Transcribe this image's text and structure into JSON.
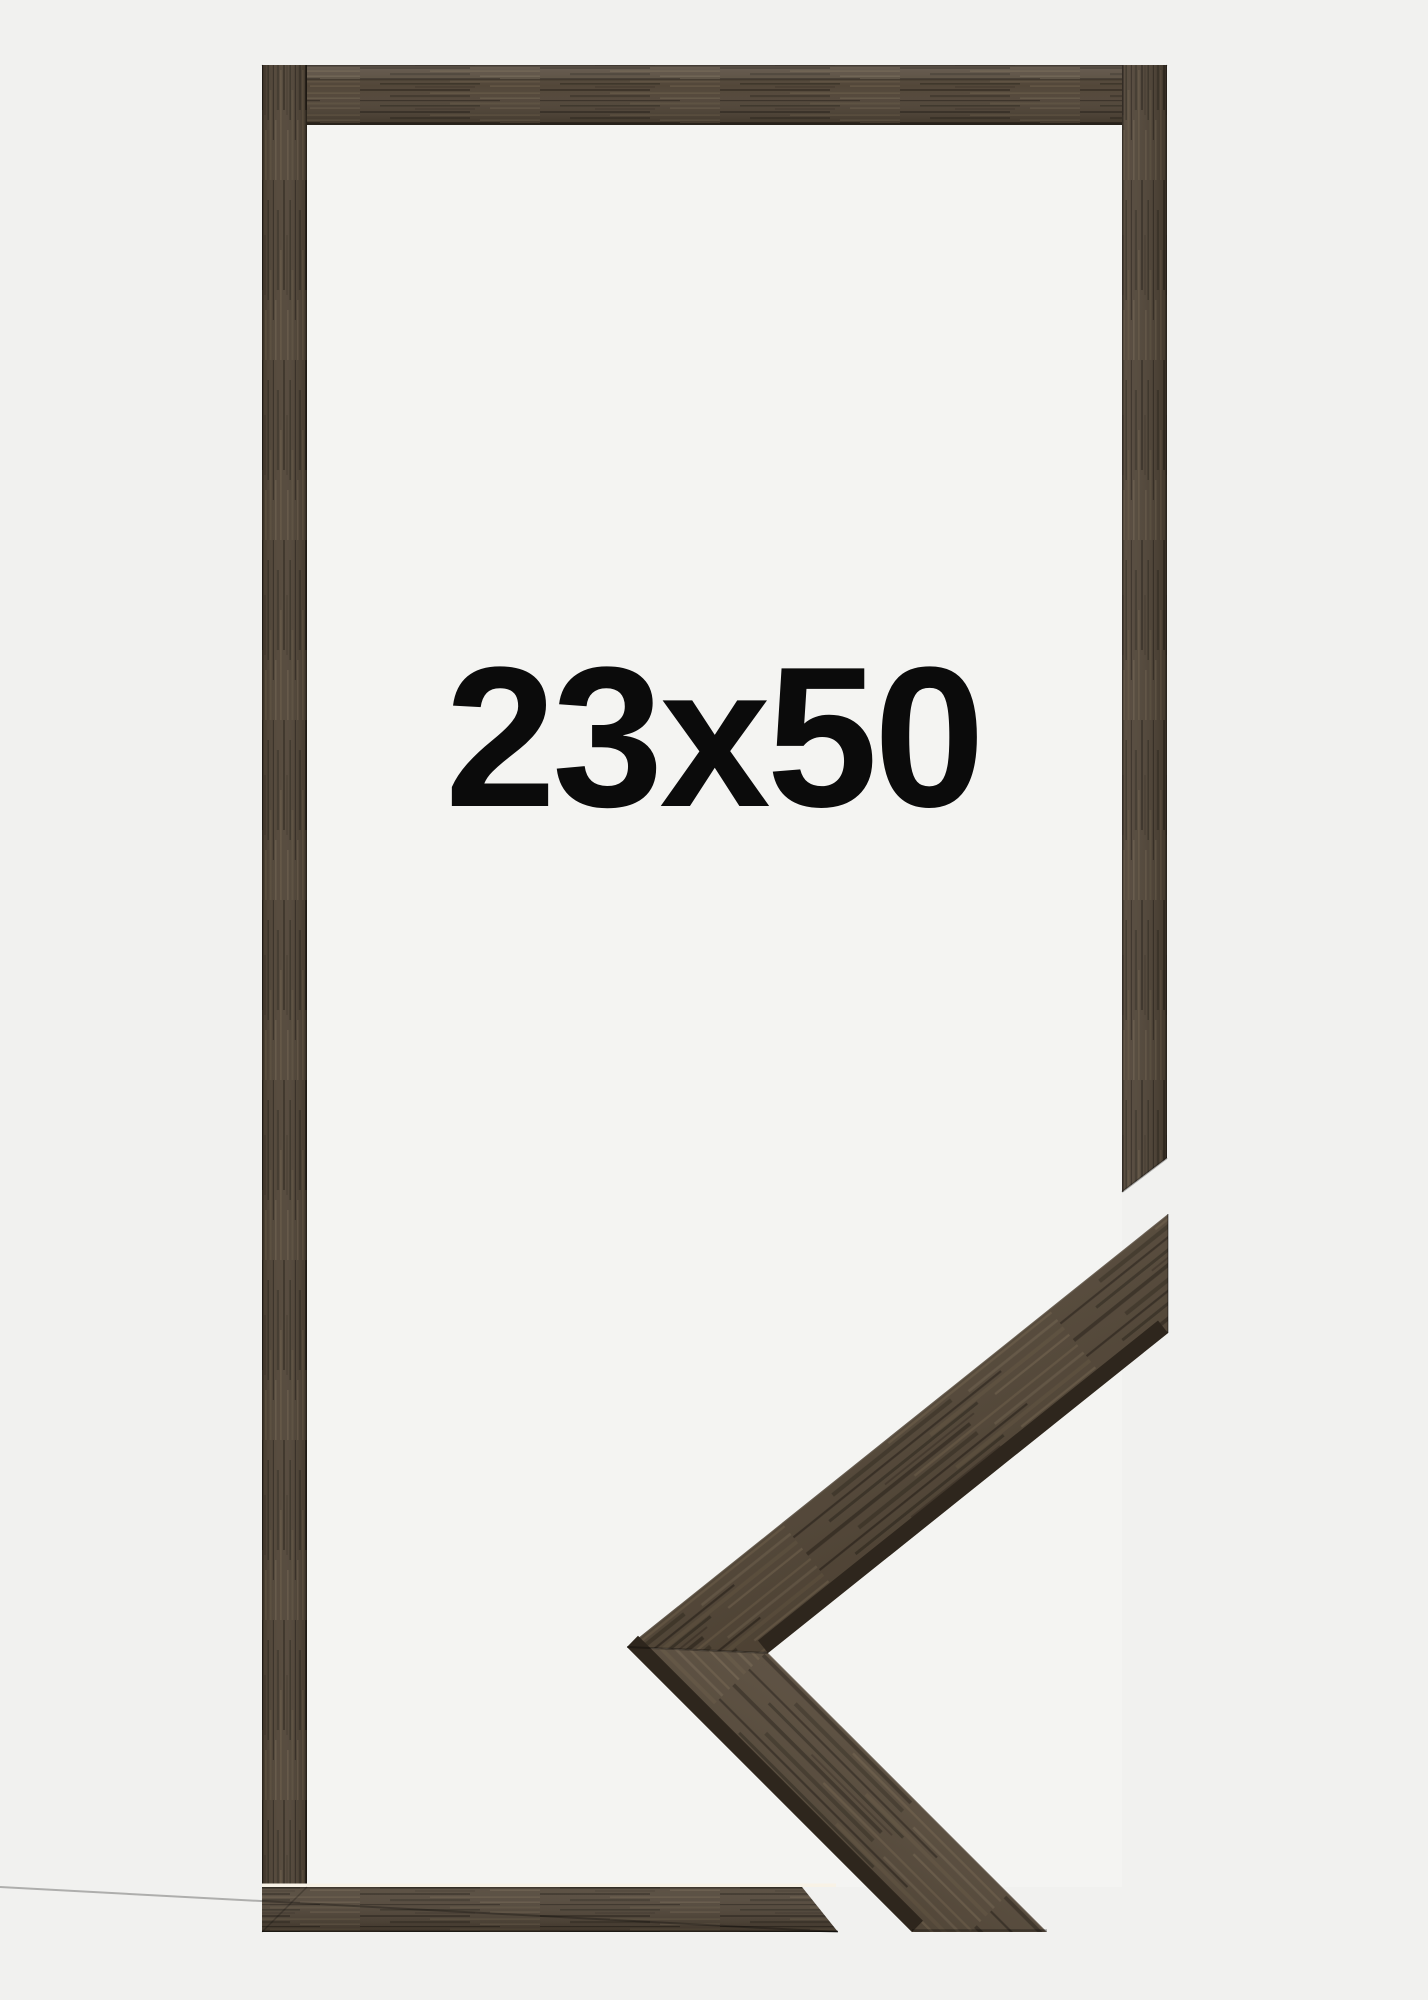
{
  "page": {
    "background_color": "#f1f1ef"
  },
  "frame_preview": {
    "size_label": "23x50",
    "label_color": "#0b0b0b",
    "wood": {
      "base": "#4f4335",
      "sample_base": "#564939",
      "side_face": "#2e261d",
      "dark_streak": "#1f1912",
      "light_streak": "#7a6950",
      "edge_highlight": "#f8f2e6"
    }
  }
}
